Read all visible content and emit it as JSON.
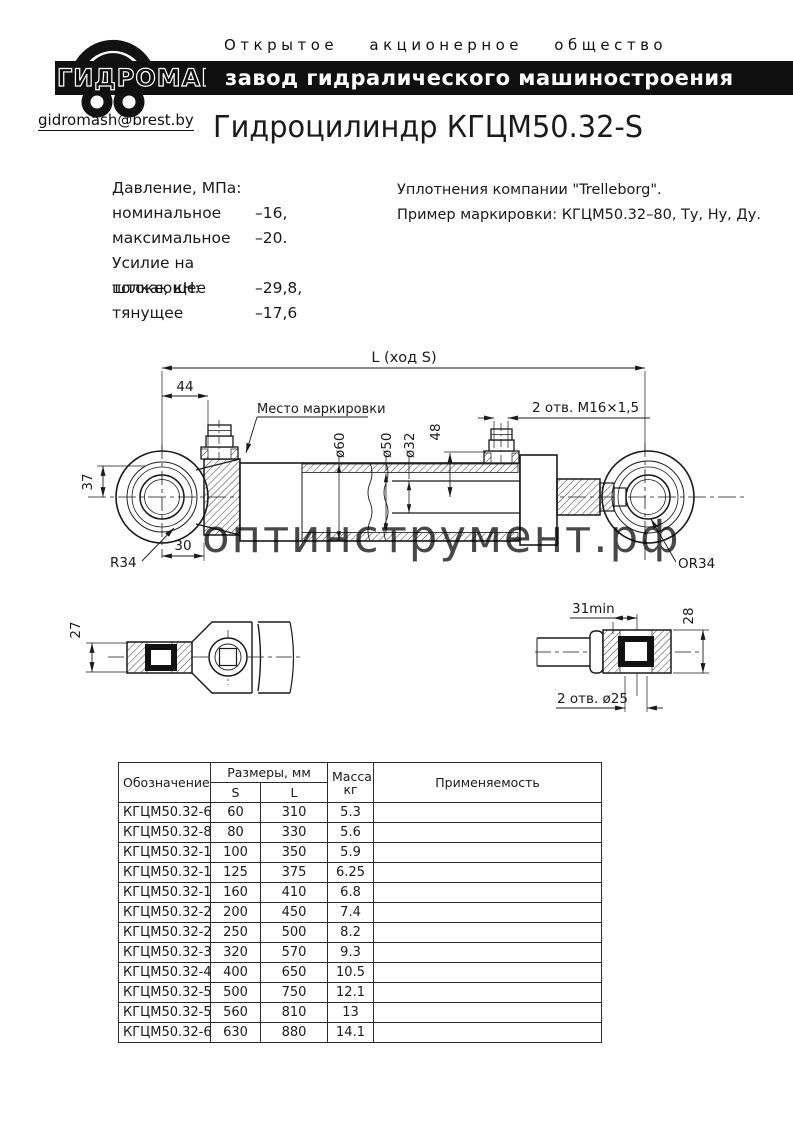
{
  "header": {
    "org_type": "Открытое акционерное общество",
    "banner": "завод гидралического машиностроения",
    "logo_text": "ГИДРОМАШ",
    "email": "gidromash@brest.by"
  },
  "title": "Гидроцилиндр КГЦМ50.32-S",
  "specs": {
    "lines": [
      {
        "label": "Давление, МПа:",
        "value": ""
      },
      {
        "label": "номинальное",
        "value": "–16,"
      },
      {
        "label": "максимальное",
        "value": "–20."
      },
      {
        "label": "Усилие на штоке, кН:",
        "value": ""
      },
      {
        "label": "толкающее",
        "value": "–29,8,"
      },
      {
        "label": "тянущее",
        "value": "–17,6"
      }
    ]
  },
  "notes": {
    "line1": "Уплотнения компании \"Trelleborg\".",
    "line2": "Пример маркировки: КГЦМ50.32–80, Ту, Ну, Ду."
  },
  "drawing": {
    "dim_total": "L (ход S)",
    "dim_44": "44",
    "marking_label": "Место маркировки",
    "ports_label": "2 отв. M16×1,5",
    "dia_60": "ø60",
    "dia_50": "ø50",
    "dia_32": "ø32",
    "dim_48": "48",
    "dim_37": "37",
    "dim_30": "30",
    "radius_left": "R34",
    "radius_right": "OR34",
    "detail_left": {
      "dim_27": "27"
    },
    "detail_right": {
      "dim_31": "31min",
      "dim_28": "28",
      "holes": "2 отв. ø25"
    },
    "watermark": "оптинструмент.рф",
    "watermark_color": "#bcc1de"
  },
  "table": {
    "col_designation": "Обозначение",
    "col_sizes": "Размеры, мм",
    "col_s": "S",
    "col_l": "L",
    "col_mass_1": "Масса,",
    "col_mass_2": "кг",
    "col_application": "Применяемость",
    "rows": [
      {
        "name": "КГЦМ50.32-60",
        "s": "60",
        "l": "310",
        "mass": "5.3",
        "application": ""
      },
      {
        "name": "КГЦМ50.32-80",
        "s": "80",
        "l": "330",
        "mass": "5.6",
        "application": ""
      },
      {
        "name": "КГЦМ50.32-100",
        "s": "100",
        "l": "350",
        "mass": "5.9",
        "application": ""
      },
      {
        "name": "КГЦМ50.32-125",
        "s": "125",
        "l": "375",
        "mass": "6.25",
        "application": ""
      },
      {
        "name": "КГЦМ50.32-160",
        "s": "160",
        "l": "410",
        "mass": "6.8",
        "application": ""
      },
      {
        "name": "КГЦМ50.32-200",
        "s": "200",
        "l": "450",
        "mass": "7.4",
        "application": ""
      },
      {
        "name": "КГЦМ50.32-250",
        "s": "250",
        "l": "500",
        "mass": "8.2",
        "application": ""
      },
      {
        "name": "КГЦМ50.32-320",
        "s": "320",
        "l": "570",
        "mass": "9.3",
        "application": ""
      },
      {
        "name": "КГЦМ50.32-400",
        "s": "400",
        "l": "650",
        "mass": "10.5",
        "application": ""
      },
      {
        "name": "КГЦМ50.32-500",
        "s": "500",
        "l": "750",
        "mass": "12.1",
        "application": ""
      },
      {
        "name": "КГЦМ50.32-560",
        "s": "560",
        "l": "810",
        "mass": "13",
        "application": ""
      },
      {
        "name": "КГЦМ50.32-630",
        "s": "630",
        "l": "880",
        "mass": "14.1",
        "application": ""
      }
    ]
  }
}
